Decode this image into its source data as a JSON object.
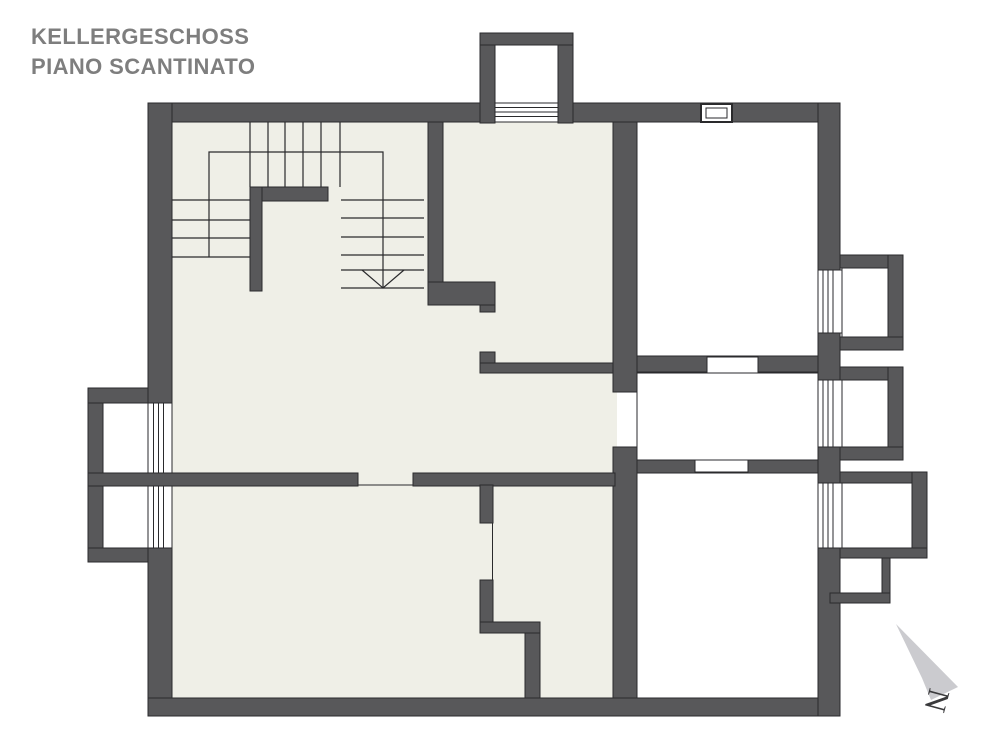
{
  "header": {
    "title_line1": "KELLERGESCHOSS",
    "title_line2": "PIANO SCANTINATO"
  },
  "compass": {
    "north_label": "N"
  },
  "colors": {
    "wall": "#58585A",
    "floor": "#EFEFE7",
    "line": "#2A2A2C",
    "title": "#7E7E7E",
    "arrow": "#CBCBCF"
  }
}
